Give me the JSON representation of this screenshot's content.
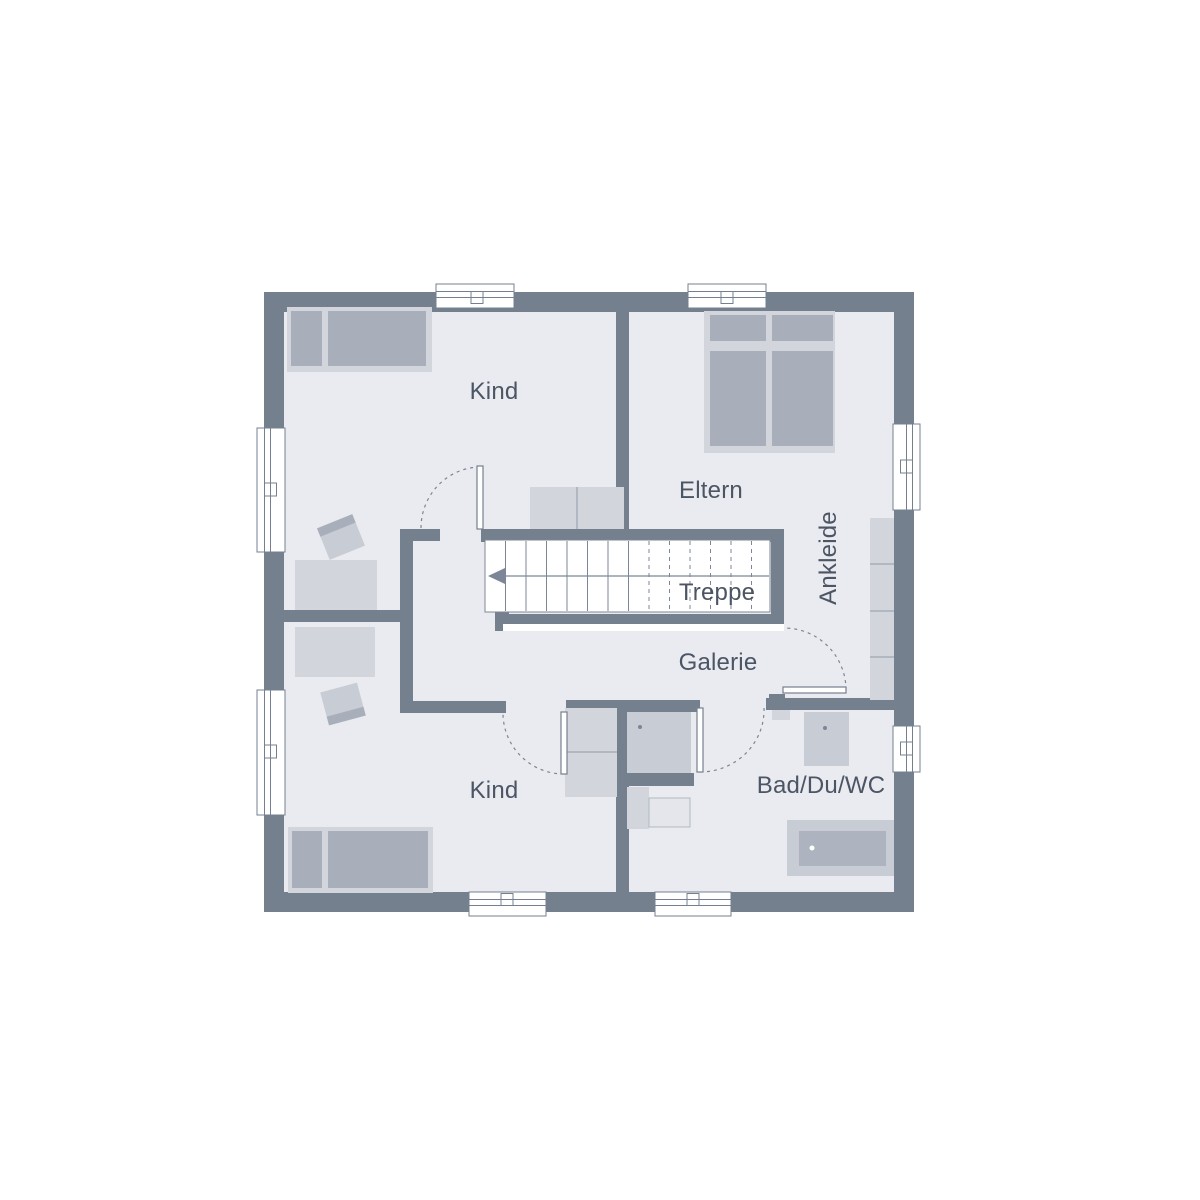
{
  "plan": {
    "type": "floor-plan",
    "floor_shown": "upper floor with gallery and stair well"
  },
  "rooms": {
    "kind_top": {
      "label": "Kind"
    },
    "eltern": {
      "label": "Eltern"
    },
    "ankleide": {
      "label": "Ankleide"
    },
    "galerie": {
      "label": "Galerie"
    },
    "kind_bottom": {
      "label": "Kind"
    },
    "bad": {
      "label": "Bad/Du/WC"
    }
  },
  "stairs": {
    "label": "Treppe",
    "arrow_direction": "left",
    "solid_steps": 7,
    "dashed_steps": 6
  },
  "doors": [
    "kind-top-door",
    "kind-bottom-door",
    "bath-door",
    "ankleide-door"
  ],
  "windows_count": 8,
  "furniture": {
    "kind_top": [
      "single-bed",
      "desk",
      "chair",
      "dresser"
    ],
    "eltern": [
      "double-bed"
    ],
    "ankleide": [
      "wardrobe"
    ],
    "kind_bottom": [
      "single-bed",
      "desk",
      "chair",
      "wardrobe"
    ],
    "bad": [
      "shower",
      "washbasin",
      "bathtub",
      "wc",
      "radiator"
    ]
  },
  "colors": {
    "wall": "#75808f",
    "floor": "#e9ebf0",
    "furniture_light": "#d2d5dc",
    "furniture_medium": "#a9afba",
    "fixture": "#c8ccd4",
    "tub_inner": "#aeb4bf",
    "wc_bowl": "#e4e6eb",
    "divider": "#b2b8c2",
    "line": "#7d8696",
    "text": "#4c5564"
  }
}
